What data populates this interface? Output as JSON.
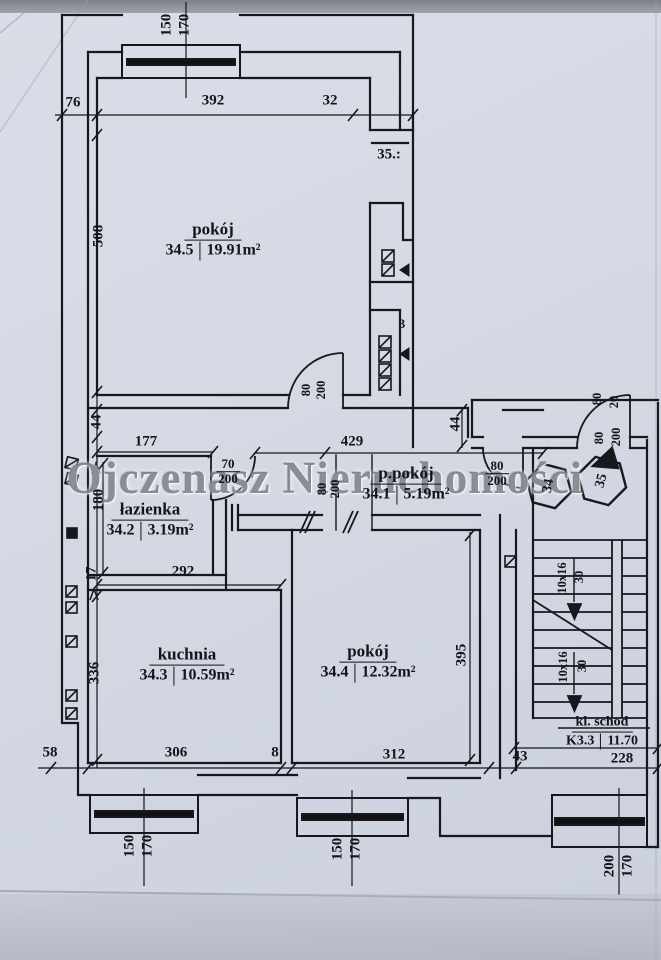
{
  "watermark": "Ojczenasz Nieruchomości",
  "rooms": {
    "r345": {
      "name": "pokój",
      "num": "34.5",
      "area": "19.91m²"
    },
    "r342": {
      "name": "łazienka",
      "num": "34.2",
      "area": "3.19m²"
    },
    "r341": {
      "name": "p.pokój",
      "num": "34.1",
      "area": "5.19m²"
    },
    "r343": {
      "name": "kuchnia",
      "num": "34.3",
      "area": "10.59m²"
    },
    "r344": {
      "name": "pokój",
      "num": "34.4",
      "area": "12.32m²"
    },
    "stair": {
      "name": "kl. schod",
      "num": "K3.3",
      "area": "11.70"
    }
  },
  "dims": {
    "t76": "76",
    "t392": "392",
    "t32": "32",
    "l508": "508",
    "l44": "44",
    "l180": "180",
    "l17": "17",
    "l336": "336",
    "h177": "177",
    "h429": "429",
    "m292": "292",
    "r44": "44",
    "r395": "395",
    "b58": "58",
    "b306": "306",
    "b8": "8",
    "b312": "312",
    "b43": "43",
    "b228": "228"
  },
  "windows": {
    "top": {
      "w": "150",
      "h": "170"
    },
    "kitchen": {
      "w": "150",
      "h": "170"
    },
    "room": {
      "w": "150",
      "h": "170"
    },
    "stair": {
      "w": "200",
      "h": "170"
    }
  },
  "doors": {
    "d345": {
      "w": "80",
      "h": "200"
    },
    "bath": {
      "w": "70",
      "h": "200"
    },
    "hall": {
      "w": "80",
      "h": "200"
    },
    "opening": {
      "w": "80",
      "h": "200"
    },
    "entry": {
      "w": "80",
      "h": "200"
    },
    "entry_top": {
      "a": "80",
      "b": "20"
    }
  },
  "stairs": {
    "f1": "10x16",
    "r1": "30",
    "f2": "10x16",
    "r2": "30"
  },
  "badges": {
    "apt": "34",
    "neighbor": "35",
    "shaft_top": "35.:",
    "shaft_n": "3"
  }
}
